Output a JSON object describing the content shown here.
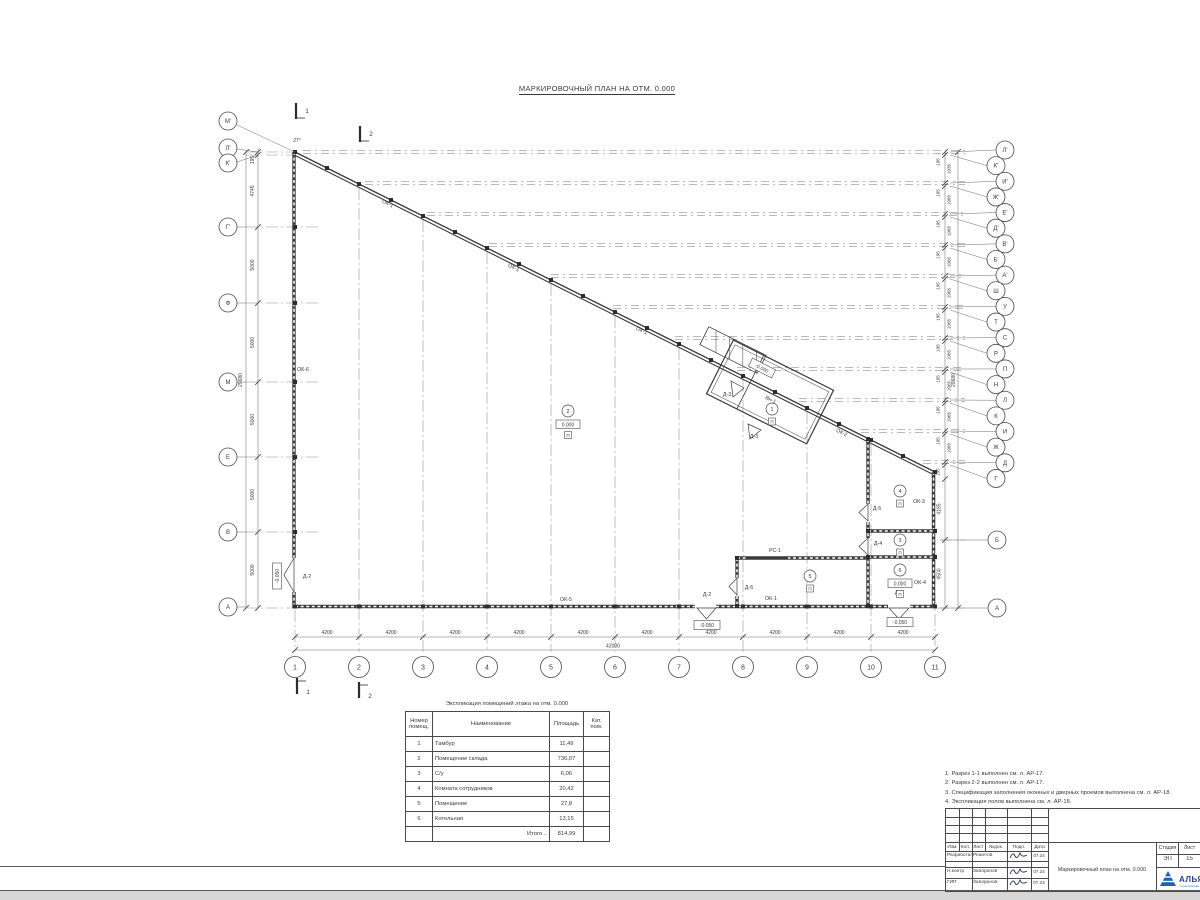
{
  "sheet": {
    "title": "МАРКИРОВОЧНЫЙ ПЛАН НА ОТМ. 0.000"
  },
  "plan": {
    "axes_left": [
      {
        "label": "М'",
        "y": 121
      },
      {
        "label": "Л'",
        "y": 148
      },
      {
        "label": "К'",
        "y": 163
      },
      {
        "label": "Г'",
        "y": 227
      },
      {
        "label": "Ф",
        "y": 303
      },
      {
        "label": "М",
        "y": 382
      },
      {
        "label": "Е",
        "y": 457
      },
      {
        "label": "В",
        "y": 532
      },
      {
        "label": "А",
        "y": 607
      }
    ],
    "axes_bottom": [
      "1",
      "2",
      "3",
      "4",
      "5",
      "6",
      "7",
      "8",
      "9",
      "10",
      "11"
    ],
    "axes_right": [
      "Л'",
      "К'",
      "И'",
      "Ж'",
      "Е'",
      "Д'",
      "В'",
      "Б'",
      "А'",
      "Ш",
      "У",
      "Т",
      "С",
      "Р",
      "П",
      "Н",
      "Л",
      "К",
      "И",
      "Ж",
      "Д",
      "Г"
    ],
    "axes_right_lower": [
      "Б",
      "А"
    ],
    "dims": {
      "bay": "4200",
      "total_width": "42000",
      "height_total": "29680",
      "left_chain": [
        "195",
        "4745",
        "5000",
        "5000",
        "5000",
        "5000",
        "5000"
      ],
      "right_pair": "195",
      "right_gap_first": "1935",
      "right_gap": "1965",
      "right_lower": [
        "4185",
        "4500"
      ],
      "angle": "27°"
    },
    "labels": [
      {
        "t": "ОК-1",
        "x": 387,
        "y": 205,
        "r": 27
      },
      {
        "t": "ОК-1",
        "x": 513,
        "y": 269,
        "r": 27
      },
      {
        "t": "ОК-1",
        "x": 641,
        "y": 332,
        "r": 27
      },
      {
        "t": "ОК-2",
        "x": 841,
        "y": 434,
        "r": 27
      },
      {
        "t": "Вн-1",
        "x": 770,
        "y": 401,
        "r": 27
      },
      {
        "t": "ОК-6",
        "x": 303,
        "y": 371,
        "r": 0
      },
      {
        "t": "ОК-5",
        "x": 566,
        "y": 601,
        "r": 0
      },
      {
        "t": "ОК-1",
        "x": 771,
        "y": 600,
        "r": 0
      },
      {
        "t": "ОК-3",
        "x": 919,
        "y": 503,
        "r": 0
      },
      {
        "t": "ОК-4",
        "x": 920,
        "y": 584,
        "r": 0
      },
      {
        "t": "РС-1",
        "x": 775,
        "y": 552,
        "r": 0
      },
      {
        "t": "Д-2",
        "x": 307,
        "y": 578,
        "r": 0
      },
      {
        "t": "Д-2",
        "x": 707,
        "y": 596,
        "r": 0
      },
      {
        "t": "Д-1",
        "x": 899,
        "y": 594,
        "r": 0
      },
      {
        "t": "Д-3",
        "x": 727,
        "y": 396,
        "r": 0
      },
      {
        "t": "Д-3",
        "x": 754,
        "y": 438,
        "r": 0
      },
      {
        "t": "Д-4",
        "x": 878,
        "y": 545,
        "r": 0
      },
      {
        "t": "Д-5",
        "x": 877,
        "y": 510,
        "r": 0
      },
      {
        "t": "Д-6",
        "x": 749,
        "y": 589,
        "r": 0
      }
    ],
    "rooms": [
      {
        "n": "1",
        "x": 772,
        "y": 409,
        "floor": "П"
      },
      {
        "n": "2",
        "x": 568,
        "y": 411,
        "elev": "0.000",
        "floor": "П"
      },
      {
        "n": "3",
        "x": 900,
        "y": 540,
        "floor": "П"
      },
      {
        "n": "4",
        "x": 900,
        "y": 491,
        "floor": "П"
      },
      {
        "n": "5",
        "x": 810,
        "y": 576,
        "floor": "П"
      },
      {
        "n": "6",
        "x": 900,
        "y": 570,
        "elev": "0.000",
        "floor": "П"
      }
    ],
    "elevations": [
      {
        "t": "-0.050",
        "x": 277,
        "y": 576,
        "r": -90
      },
      {
        "t": "-0.050",
        "x": 762,
        "y": 368,
        "r": 27
      },
      {
        "t": "-0.050",
        "x": 707,
        "y": 625,
        "r": 0
      },
      {
        "t": "-0.050",
        "x": 900,
        "y": 622,
        "r": 0
      }
    ],
    "sections": [
      {
        "n": "1",
        "x": 296,
        "y": 103,
        "pos": "top"
      },
      {
        "n": "2",
        "x": 360,
        "y": 126,
        "pos": "top"
      },
      {
        "n": "1",
        "x": 297,
        "y": 678,
        "pos": "bottom"
      },
      {
        "n": "2",
        "x": 359,
        "y": 682,
        "pos": "bottom"
      }
    ]
  },
  "legend_table": {
    "title": "Экспликация помещений этажа на отм. 0.000",
    "headers": [
      "Номер помещ.",
      "Наименование",
      "Площадь",
      "Кат. пом."
    ],
    "rows": [
      [
        "1",
        "Тамбур",
        "11,49",
        ""
      ],
      [
        "2",
        "Помещение склада",
        "736,07",
        ""
      ],
      [
        "3",
        "С/у",
        "6,06",
        ""
      ],
      [
        "4",
        "Комната сотрудников",
        "20,42",
        ""
      ],
      [
        "5",
        "Помещение",
        "27,8",
        ""
      ],
      [
        "6",
        "Котельная",
        "13,15",
        ""
      ]
    ],
    "total_label": "Итого ..",
    "total_value": "814,99"
  },
  "notes": [
    "1. Разрез 1-1 выполнен см. л. АР-17.",
    "2. Разрез 2-2 выполнен см. л. АР-17.",
    "3. Спецификация заполнения оконных и дверных проемов выполнена см. л. АР-18.",
    "4. Экспликация полов выполнена см. л. АР-18."
  ],
  "titleblock": {
    "header_cols": [
      "Изм.",
      "Кол.",
      "Лист",
      "№док.",
      "Подп.",
      "Дата"
    ],
    "sign_rows": [
      {
        "role": "Разработал",
        "name": "Решетов",
        "date": "07.24"
      },
      {
        "role": "Н.контр",
        "name": "Заборонов",
        "date": "07.24"
      },
      {
        "role": "ГИП",
        "name": "Заборонов",
        "date": "07.24"
      }
    ],
    "doc_title": "Маркировочный план на отм. 0.000",
    "stage_label": "Стадия",
    "stage": "ЭП",
    "sheet_label": "Лист",
    "sheet_no": "15",
    "company": "АЛЬЯНС",
    "company_sub": "строительная компания",
    "logo_color": "#1e62b0"
  }
}
